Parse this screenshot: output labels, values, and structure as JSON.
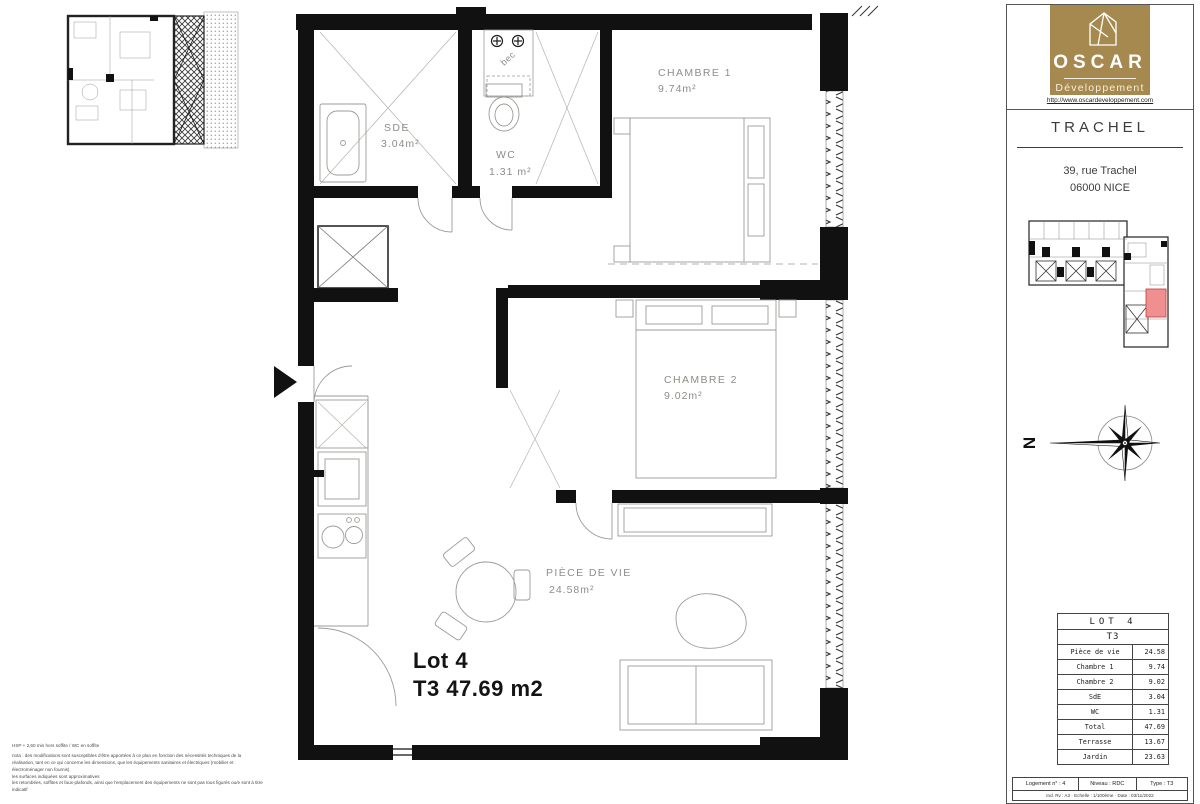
{
  "plan": {
    "rooms": [
      {
        "name": "CHAMBRE 1",
        "area": "9.74m²"
      },
      {
        "name": "CHAMBRE 2",
        "area": "9.02m²"
      },
      {
        "name": "SDE",
        "area": "3.04m²"
      },
      {
        "name": "WC",
        "area": "1.31 m²"
      },
      {
        "name": "PIÈCE DE VIE",
        "area": "24.58m²"
      }
    ],
    "labels": {
      "bec": "bec",
      "lot_title": "Lot 4",
      "lot_area": "T3 47.69 m2"
    },
    "notes": {
      "line1": "HSP + 2,60 min hors soffite / WC en soffite",
      "para1": "nota : des modifications sont susceptibles d'être apportées à ce plan en fonction des nécessités techniques de la réalisation, tant en ce qui concerne les dimensions, que les équipements sanitaires et électriques (mobilier et électroménager non fournis)",
      "para2": "les surfaces indiquées sont approximatives",
      "para3": "les retombées, soffites et faux-plafonds, ainsi que l'emplacement des équipements ne sont pas tous figurés ou/e sont à titre indicatif"
    }
  },
  "sidebar": {
    "logo": {
      "name": "OSCAR",
      "tagline": "Développement",
      "url": "http://www.oscardeveloppement.com",
      "brand_color": "#a6894f"
    },
    "project": {
      "title": "TRACHEL",
      "address_line1": "39, rue Trachel",
      "address_line2": "06000 NICE"
    },
    "compass_label": "N",
    "highlight_color": "#f08f8f",
    "table": {
      "title": "LOT 4",
      "subtitle": "T3",
      "rows": [
        {
          "label": "Pièce de vie",
          "value": "24.58"
        },
        {
          "label": "Chambre 1",
          "value": "9.74"
        },
        {
          "label": "Chambre 2",
          "value": "9.02"
        },
        {
          "label": "SdE",
          "value": "3.04"
        },
        {
          "label": "WC",
          "value": "1.31"
        },
        {
          "label": "Total",
          "value": "47.69"
        },
        {
          "label": "Terrasse",
          "value": "13.67"
        },
        {
          "label": "Jardin",
          "value": "23.63"
        }
      ]
    },
    "footer": {
      "cell1": "Logement n° : 4",
      "cell2": "Niveau : RDC",
      "cell3": "Type : T3",
      "meta": "Ind. Rv : A3 · Echelle : 1/100ème · Date : 03/11/2022"
    }
  }
}
